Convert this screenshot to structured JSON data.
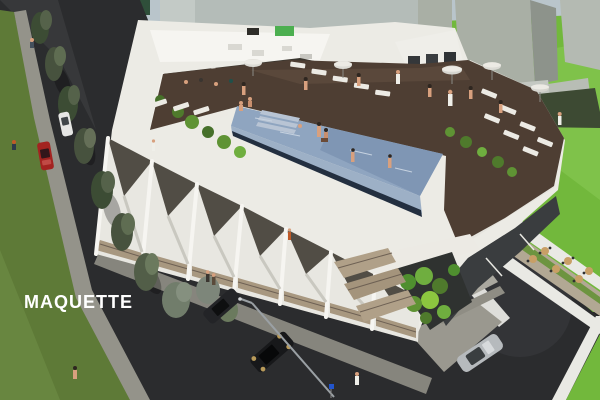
{
  "watermark": {
    "label": "MAQUETTE",
    "color": "#ffffff"
  },
  "scene": {
    "type": "aerial-architectural-rendering",
    "subject": "modern apartment building with rooftop infinity pool",
    "colors": {
      "sky": "#b9c5cb",
      "asphalt": "#2b2c2e",
      "sidewalk": "#94938a",
      "grass_bright": "#72b83c",
      "grass_olive": "#5e7a37",
      "building_white": "#ecebe5",
      "deck_brown": "#4e3e33",
      "pool_water": "#8fa5c0",
      "pool_face": "#9db0c6",
      "context_block": "#a9afa5",
      "foliage": "#47523e",
      "dark_glass": "#3a3d3f",
      "balcony_wood": "#a89880",
      "red_car": "#a32320",
      "silver_car": "#b6babd",
      "dark_car": "#17181a",
      "white_car": "#e6e6e4"
    },
    "visible_objects": [
      "rooftop infinity pool with swimmers",
      "wood pool deck with sun loungers and parasols",
      "zigzag white facade with balconies",
      "street with parked cars (red, white, two dark, silver)",
      "street trees and lawns",
      "context massing blocks",
      "courtyard terrace with bistro tables",
      "street lamp and pedestrians"
    ]
  }
}
